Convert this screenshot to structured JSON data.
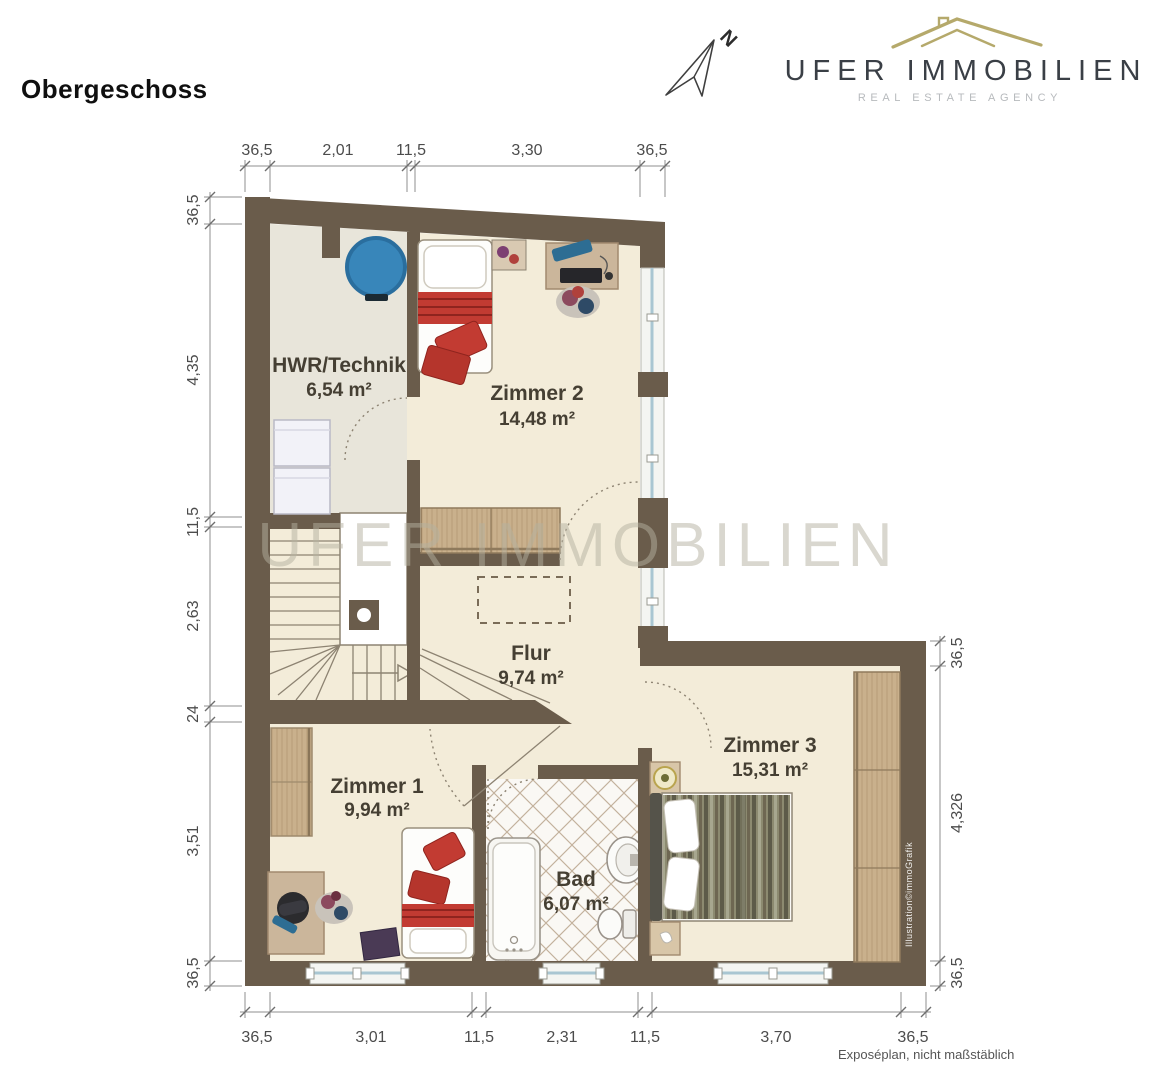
{
  "page": {
    "title": "Obergeschoss",
    "footnote": "Exposéplan, nicht maßstäblich",
    "credit": "Illustration©immoGrafik",
    "watermark": "UFER IMMOBILIEN"
  },
  "logo": {
    "name": "UFER IMMOBILIEN",
    "subtitle": "REAL ESTATE AGENCY",
    "compass_label": "N"
  },
  "rooms": [
    {
      "name": "HWR/Technik",
      "area": "6,54 m²"
    },
    {
      "name": "Zimmer 2",
      "area": "14,48 m²"
    },
    {
      "name": "Flur",
      "area": "9,74 m²"
    },
    {
      "name": "Zimmer 1",
      "area": "9,94 m²"
    },
    {
      "name": "Bad",
      "area": "6,07 m²"
    },
    {
      "name": "Zimmer 3",
      "area": "15,31 m²"
    }
  ],
  "dimensions": {
    "top": [
      "36,5",
      "2,01",
      "11,5",
      "3,30",
      "36,5"
    ],
    "left": [
      "36,5",
      "4,35",
      "11,5",
      "2,63",
      "24",
      "3,51",
      "36,5"
    ],
    "right": [
      "36,5",
      "4,326",
      "36,5"
    ],
    "bottom": [
      "36,5",
      "3,01",
      "11,5",
      "2,31",
      "11,5",
      "3,70",
      "36,5"
    ]
  },
  "colors": {
    "wall": "#6a5c4b",
    "floor": "#f3ecd9",
    "hwr_floor": "#e8e5da",
    "wood": "#cbb69b",
    "accent_red": "#c23b32",
    "tank_blue": "#3886ba",
    "glass_blue": "#a9c6d2",
    "roof_gold": "#b5a96b",
    "logo_text": "#3a3f46",
    "watermark": "#b5b1a0"
  }
}
